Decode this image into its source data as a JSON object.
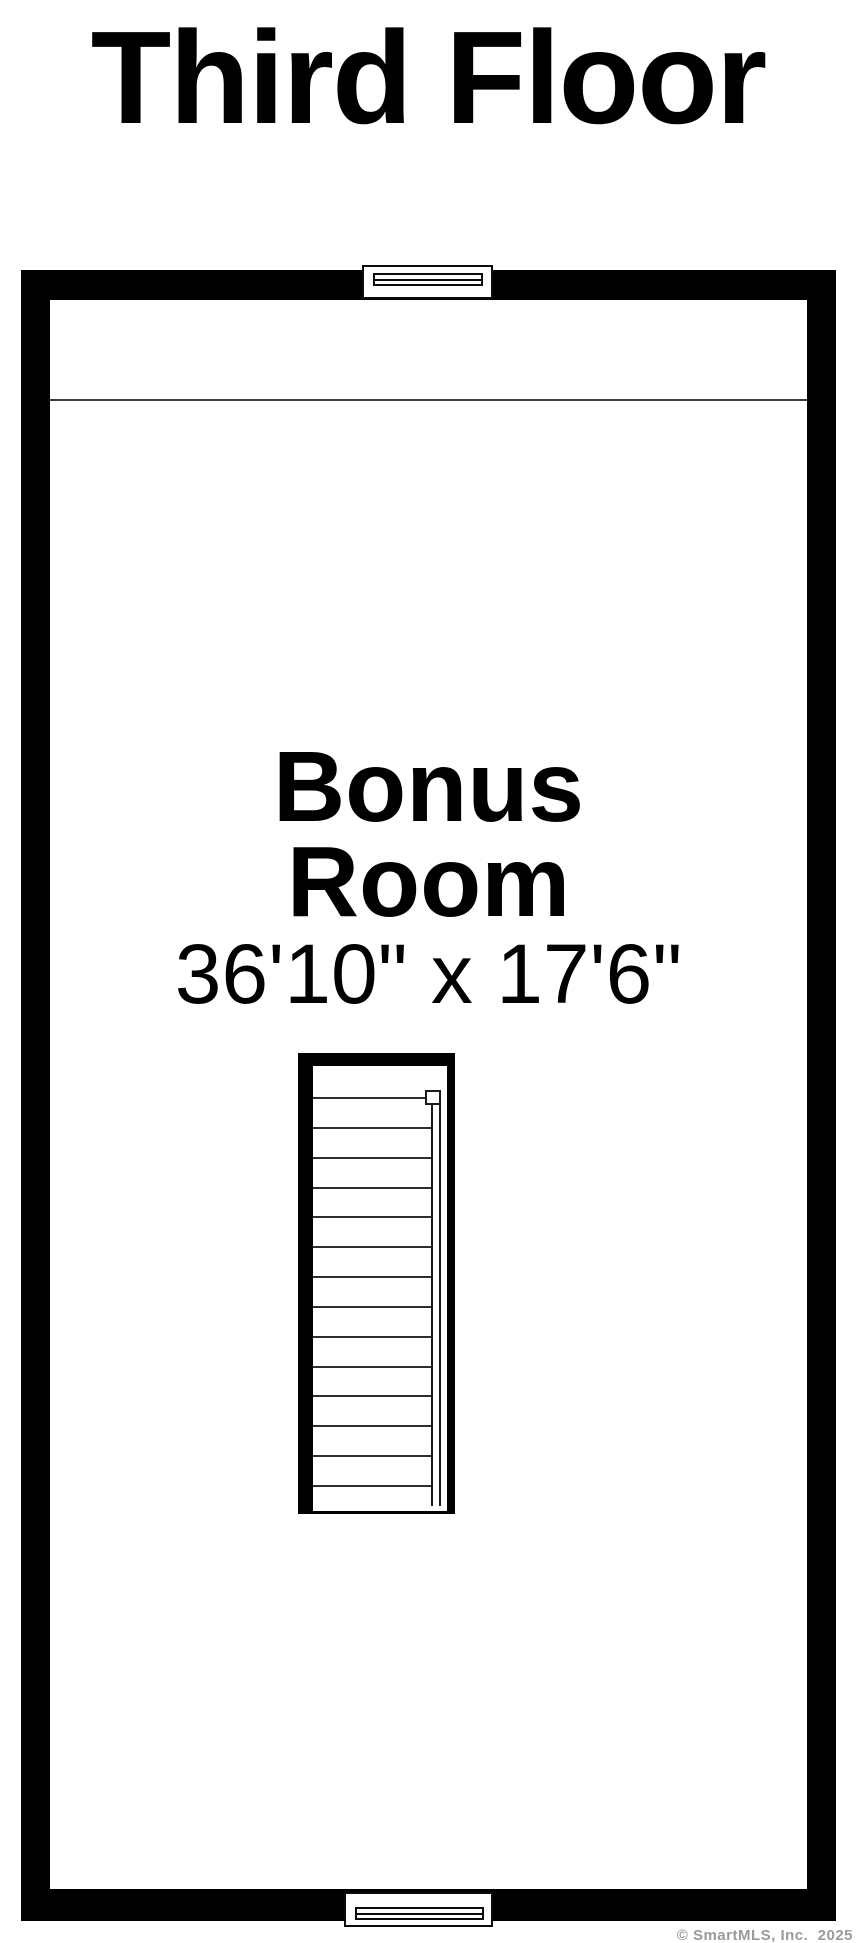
{
  "title": "Third Floor",
  "floorplan": {
    "room": {
      "name_line1": "Bonus",
      "name_line2": "Room",
      "dimensions": "36'10\" x 17'6\""
    },
    "staircase": {
      "tread_count": 14,
      "handrail_side": "right"
    },
    "windows": [
      {
        "position": "top-center"
      },
      {
        "position": "bottom-center"
      }
    ]
  },
  "watermark": {
    "text": "© SmartMLS, Inc.  2025"
  },
  "colors": {
    "wall": "#000000",
    "text": "#000000",
    "divider": "#3d3d44",
    "tread": "#2e2e2e",
    "watermark": "#9a9a9a",
    "bg": "#ffffff"
  }
}
